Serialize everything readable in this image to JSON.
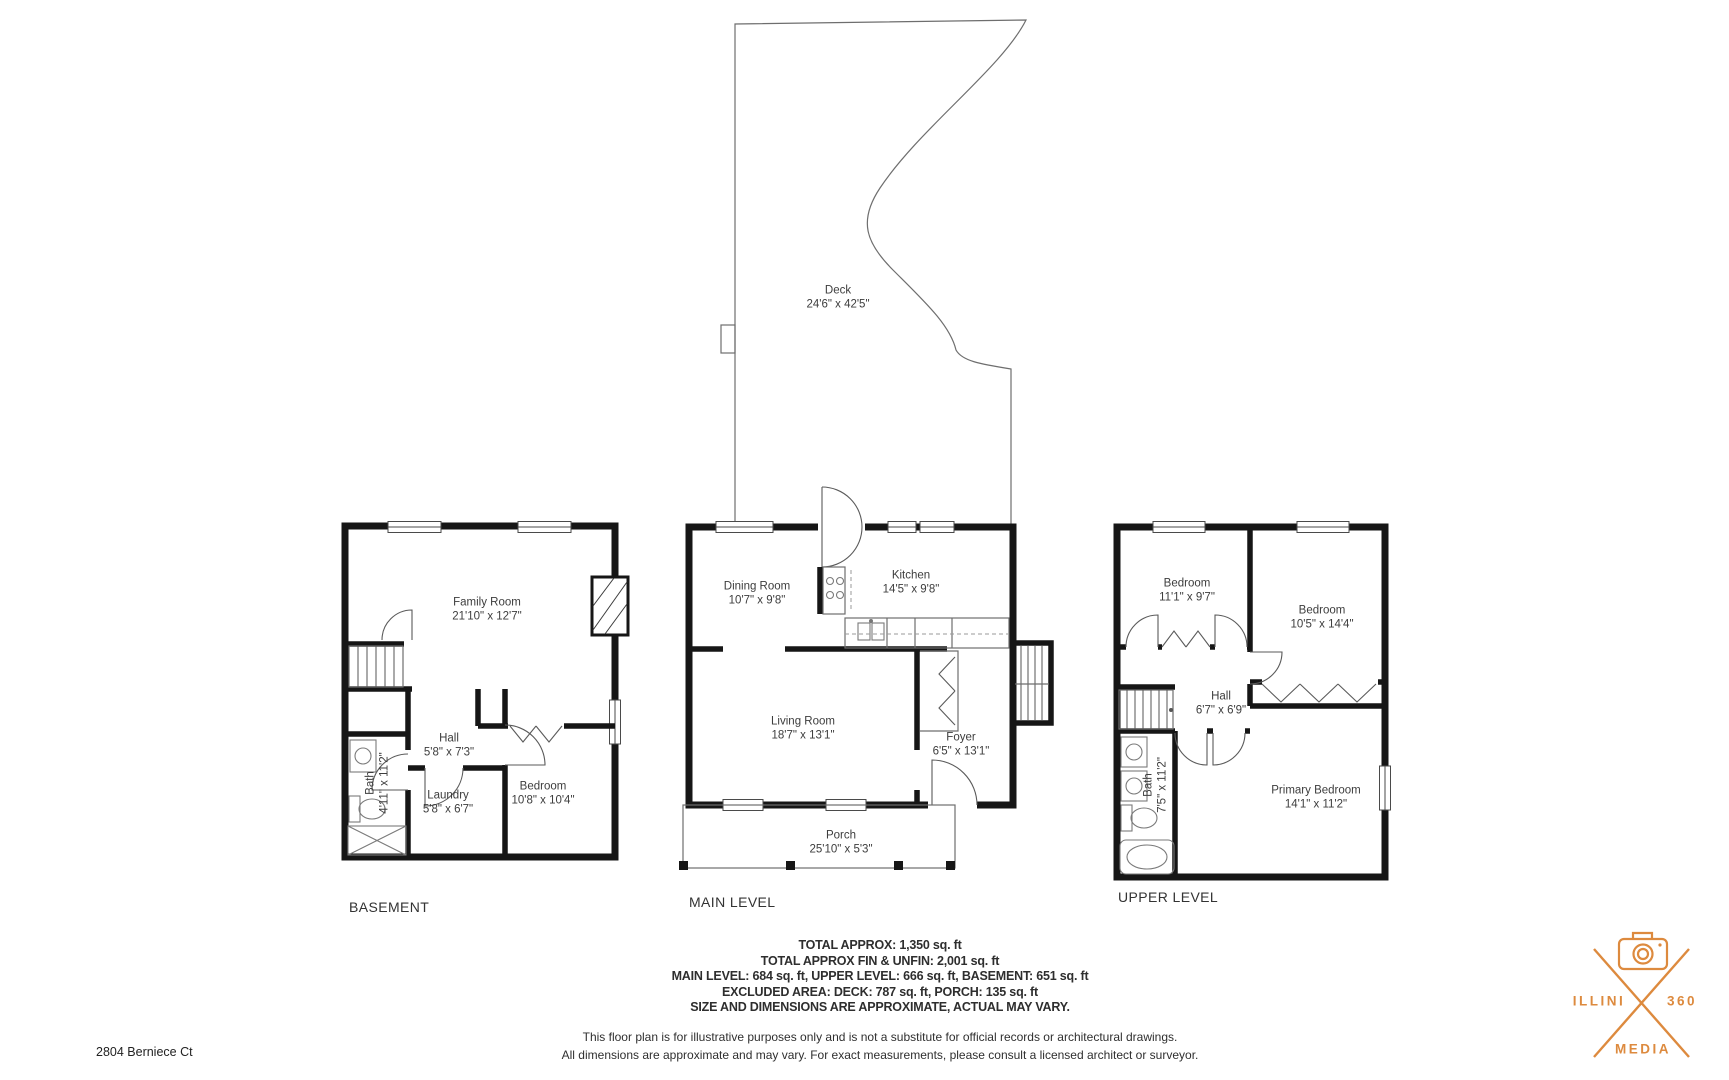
{
  "canvas": {
    "width": 1729,
    "height": 1080,
    "background": "#ffffff"
  },
  "address": "2804 Berniece Ct",
  "deck": {
    "name": "Deck",
    "dims": "24'6\" x 42'5\""
  },
  "levels": [
    {
      "title": "BASEMENT",
      "rooms": [
        {
          "name": "Family Room",
          "dims": "21'10\" x 12'7\""
        },
        {
          "name": "Hall",
          "dims": "5'8\" x 7'3\""
        },
        {
          "name": "Bath",
          "dims": "4'11\" x 11'2\""
        },
        {
          "name": "Laundry",
          "dims": "5'8\" x 6'7\""
        },
        {
          "name": "Bedroom",
          "dims": "10'8\" x 10'4\""
        }
      ]
    },
    {
      "title": "MAIN LEVEL",
      "rooms": [
        {
          "name": "Dining Room",
          "dims": "10'7\" x 9'8\""
        },
        {
          "name": "Kitchen",
          "dims": "14'5\" x 9'8\""
        },
        {
          "name": "Living Room",
          "dims": "18'7\" x 13'1\""
        },
        {
          "name": "Foyer",
          "dims": "6'5\" x 13'1\""
        },
        {
          "name": "Porch",
          "dims": "25'10\" x 5'3\""
        }
      ]
    },
    {
      "title": "UPPER LEVEL",
      "rooms": [
        {
          "name": "Bedroom",
          "dims": "11'1\" x 9'7\""
        },
        {
          "name": "Bedroom",
          "dims": "10'5\" x 14'4\""
        },
        {
          "name": "Hall",
          "dims": "6'7\" x 6'9\""
        },
        {
          "name": "Bath",
          "dims": "7'5\" x 11'2\""
        },
        {
          "name": "Primary Bedroom",
          "dims": "14'1\" x 11'2\""
        }
      ]
    }
  ],
  "summary": {
    "lines": [
      "TOTAL APPROX: 1,350 sq. ft",
      "TOTAL APPROX FIN & UNFIN: 2,001 sq. ft",
      "MAIN LEVEL: 684 sq. ft, UPPER LEVEL: 666 sq. ft, BASEMENT: 651 sq. ft",
      "EXCLUDED AREA: DECK: 787 sq. ft, PORCH: 135 sq. ft",
      "SIZE AND DIMENSIONS ARE APPROXIMATE, ACTUAL MAY VARY."
    ]
  },
  "disclaimer": {
    "line1": "This floor plan is for illustrative purposes only and is not a substitute for official records or architectural drawings.",
    "line2": "All dimensions are approximate and may vary. For exact measurements, please consult a licensed architect or surveyor."
  },
  "logo": {
    "word_left": "ILLINI",
    "word_right": "360",
    "word_bottom": "MEDIA",
    "color": "#DD8A3E"
  }
}
